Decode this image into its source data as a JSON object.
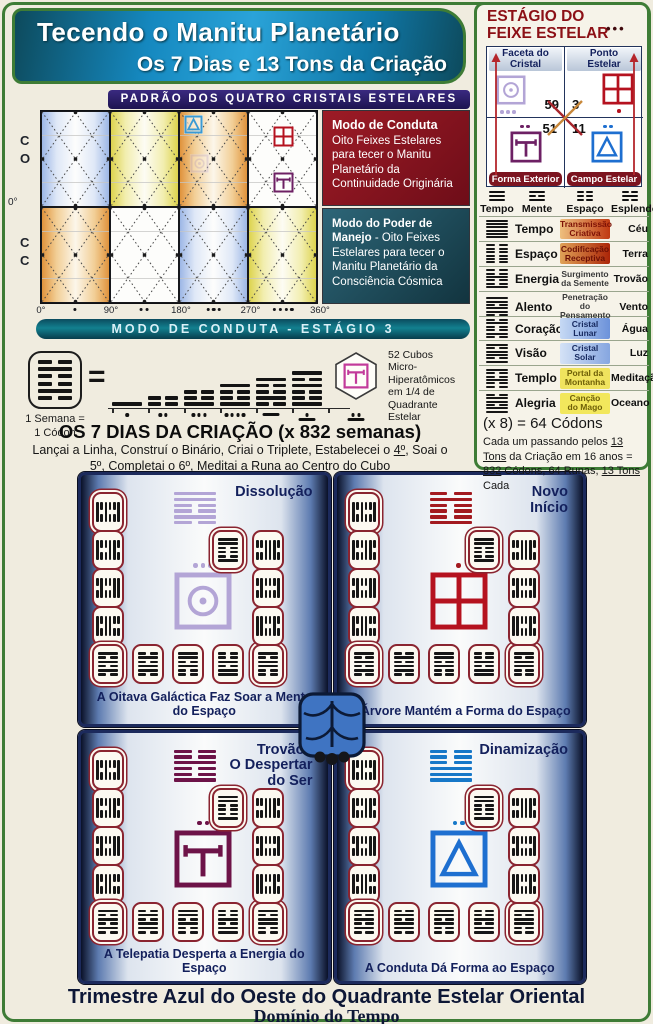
{
  "palette": {
    "frame_green": "#3e7c36",
    "header_blue": "#1a8fc4",
    "banner_purple": "#241a60",
    "box_red": "#8e1420",
    "box_teal": "#1f5a6b",
    "banner_teal": "#0e6f80",
    "navy": "#13205c",
    "card_border": "#8a2430",
    "seal_lavender": "#b3a5d6",
    "seal_red": "#b5121f",
    "seal_purple": "#6d2064",
    "seal_blue": "#1e6fd0",
    "mask_blue": "#3f74c2"
  },
  "header": {
    "title": "Tecendo o Manitu Planetário",
    "subtitle": "Os 7 Dias e 13 Tons da Criação"
  },
  "padrao_banner": "PADRÃO DOS QUATRO CRISTAIS ESTELARES",
  "chart": {
    "y_top_letters": [
      "C",
      "O"
    ],
    "y_mid": "0°",
    "y_bottom_letters": [
      "C",
      "C"
    ],
    "x_ticks": [
      "0°",
      "90°",
      "180°",
      "270°",
      "360°"
    ],
    "x_dot_groups": [
      1,
      2,
      3,
      4
    ],
    "panel_colors_top": [
      "blue",
      "yellow",
      "orange",
      "white"
    ],
    "panel_colors_bottom": [
      "orange",
      "white",
      "blue",
      "yellow"
    ],
    "overlay_glyphs": [
      {
        "row": 0,
        "col": 2,
        "seal": "star-field",
        "color": "#3a9ad4",
        "pos": "tl",
        "faded": false,
        "size": 19
      },
      {
        "row": 0,
        "col": 2,
        "seal": "crystal-facet",
        "color": "#c4b4d6",
        "pos": "ml",
        "faded": true,
        "size": 19
      },
      {
        "row": 0,
        "col": 3,
        "seal": "star-point",
        "color": "#b5121f",
        "pos": "um",
        "faded": false,
        "size": 21
      },
      {
        "row": 0,
        "col": 3,
        "seal": "exterior-form",
        "color": "#6d2064",
        "pos": "lm",
        "faded": false,
        "size": 21
      }
    ]
  },
  "mode_boxes": {
    "conduta_title": "Modo de Conduta",
    "conduta_body": "Oito Feixes Estelares para tecer o Manitu Planetário da Continuidade Originária",
    "manejo_title": "Modo do Poder de Manejo",
    "manejo_body": " - Oito Feixes Estelares para tecer o Manitu Planetário da Consciência Cósmica"
  },
  "conduta_banner": "MODO DE CONDUTA - ESTÁGIO 3",
  "seven_days": {
    "codon_icon_lines": [
      0,
      1,
      0,
      0,
      1,
      0
    ],
    "week_label": "1 Semana =\n1 Códon",
    "equals": "=",
    "day_stacks": [
      [
        1
      ],
      [
        0,
        0
      ],
      [
        0,
        0,
        1
      ],
      [
        1,
        0,
        0,
        1
      ],
      [
        1,
        0,
        0,
        1,
        0
      ],
      [
        1,
        0,
        1,
        0,
        0,
        1
      ]
    ],
    "mayan_values": [
      1,
      2,
      3,
      4,
      5,
      6,
      7
    ],
    "hexagon_seal": "exterior-form",
    "hexagon_seal_color": "#c23a9a",
    "cubes_note": "52 Cubos\nMicro-Hiperatômicos\nem 1/4 de Quadrante\nEstelar",
    "title": "OS 7 DIAS DA CRIAÇÃO (x 832 semanas)",
    "subtitle_segments": [
      {
        "t": "Lançai a Linha, Construí o Binário, Criai o Triplete, Estabelecei o "
      },
      {
        "t": "4º",
        "u": true
      },
      {
        "t": ", Soai o "
      },
      {
        "t": "5º",
        "u": true
      },
      {
        "t": ", Completai o "
      },
      {
        "t": "6º",
        "u": true
      },
      {
        "t": ", Meditai a Runa ao Centro do Cubo"
      }
    ]
  },
  "estagio": {
    "title_line1": "ESTÁGIO DO",
    "title_line2": "FEIXE ESTELAR",
    "dots": "•••",
    "cells": {
      "tl": {
        "label": "Faceta do\nCristal",
        "number": "59",
        "seal": "crystal-facet",
        "seal_color": "#b3a5d6",
        "dots_below": 3
      },
      "tr": {
        "label": "Ponto\nEstelar",
        "number": "3",
        "seal": "star-point",
        "seal_color": "#b5121f",
        "dots_below": 1
      },
      "bl": {
        "ribbon": "Forma Exterior",
        "number": "51",
        "seal": "exterior-form",
        "seal_color": "#6d2064",
        "dots_above": 2
      },
      "br": {
        "ribbon": "Campo Estelar",
        "number": "11",
        "seal": "star-field",
        "seal_color": "#1e6fd0",
        "dots_above": 2
      }
    }
  },
  "matrix": {
    "trigrams": [
      [
        1,
        1,
        1
      ],
      [
        1,
        0,
        1
      ],
      [
        0,
        0,
        0
      ],
      [
        0,
        1,
        0
      ]
    ],
    "headers": [
      "Tempo",
      "Mente",
      "Espaço",
      "Esplendor"
    ],
    "rows": [
      {
        "hex": [
          1,
          1,
          1,
          1,
          1,
          1
        ],
        "name": "Tempo",
        "phrase": "Transmissão\nCriativa",
        "result": "Céu",
        "bg": "linear-gradient(90deg,#eebf7e,#c03a12)",
        "fg": "#7e1206"
      },
      {
        "hex": [
          0,
          0,
          0,
          0,
          0,
          0
        ],
        "name": "Espaço",
        "phrase": "Codificação\nReceptiva",
        "result": "Terra",
        "bg": "linear-gradient(90deg,#e0a257,#ab2508)",
        "fg": "#6d1005"
      },
      {
        "hex": [
          0,
          0,
          1,
          0,
          0,
          1
        ],
        "name": "Energia",
        "phrase": "Surgimento\nda Semente",
        "result": "Trovão",
        "bg": "transparent",
        "fg": "#3a3a3a"
      },
      {
        "hex": [
          1,
          1,
          0,
          1,
          1,
          0
        ],
        "name": "Alento",
        "phrase": "Penetração do\nPensamento",
        "result": "Vento",
        "bg": "transparent",
        "fg": "#3a3a3a"
      },
      {
        "hex": [
          0,
          1,
          0,
          0,
          1,
          0
        ],
        "name": "Coração",
        "phrase": "Cristal\nLunar",
        "result": "Água",
        "bg": "linear-gradient(90deg,#c6d9f4,#6c92da)",
        "fg": "#16295f"
      },
      {
        "hex": [
          1,
          0,
          1,
          1,
          0,
          1
        ],
        "name": "Visão",
        "phrase": "Cristal\nSolar",
        "result": "Luz",
        "bg": "linear-gradient(90deg,#d4e2f6,#86a6e0)",
        "fg": "#16295f"
      },
      {
        "hex": [
          1,
          0,
          0,
          1,
          0,
          0
        ],
        "name": "Templo",
        "phrase": "Portal da\nMontanha",
        "result": "Meditação",
        "bg": "#f0e35e",
        "fg": "#6f6008"
      },
      {
        "hex": [
          0,
          1,
          1,
          0,
          1,
          1
        ],
        "name": "Alegria",
        "phrase": "Canção\ndo Mago",
        "result": "Oceano",
        "bg": "#f2e75c",
        "fg": "#6f6008"
      }
    ]
  },
  "codons": {
    "line1": "(x 8) = 64 Códons",
    "segments": [
      {
        "t": "Cada um passando pelos "
      },
      {
        "t": "13 Tons",
        "u": true
      },
      {
        "t": " da Criação em 16 anos = "
      },
      {
        "t": "832",
        "u": true
      },
      {
        "t": " Códons, 64 Runas, "
      },
      {
        "t": "13 Tons",
        "u": true
      },
      {
        "t": " Cada"
      }
    ]
  },
  "quadrants": [
    {
      "title": "Dissolução",
      "hexagram": [
        1,
        1,
        0,
        0,
        1,
        0
      ],
      "ink": "#b3a5d6",
      "seal": "crystal-facet",
      "seal_color": "#b3a5d6",
      "dots": 3,
      "caption": "A Oitava Galáctica Faz Soar a Mente do Espaço"
    },
    {
      "title": "Novo\nInício",
      "hexagram": [
        0,
        1,
        0,
        0,
        0,
        1
      ],
      "ink": "#a31a20",
      "seal": "star-point",
      "seal_color": "#b5121f",
      "dots": 1,
      "caption": "A Árvore Mantém a Forma do Espaço"
    },
    {
      "title": "Trovão /\nO Despertar\ndo Ser",
      "hexagram": [
        0,
        0,
        1,
        0,
        0,
        1
      ],
      "ink": "#6d1348",
      "seal": "exterior-form",
      "seal_color": "#6d1348",
      "dots": 2,
      "caption": "A Telepatia Desperta a Energia do Espaço"
    },
    {
      "title": "Dinamização",
      "hexagram": [
        0,
        0,
        0,
        1,
        1,
        1
      ],
      "ink": "#1778c8",
      "seal": "star-field",
      "seal_color": "#1e6fd0",
      "dots": 2,
      "caption": "A Conduta Dá Forma ao Espaço"
    }
  ],
  "card_patterns": [
    [
      1,
      0,
      0,
      1,
      0,
      1
    ],
    [
      0,
      1,
      1,
      0,
      0,
      1
    ],
    [
      1,
      1,
      0,
      0,
      1,
      0
    ],
    [
      0,
      0,
      1,
      1,
      0,
      1
    ],
    [
      1,
      0,
      1,
      0,
      1,
      0
    ],
    [
      0,
      1,
      0,
      1,
      1,
      0
    ],
    [
      1,
      1,
      0,
      1,
      0,
      0
    ],
    [
      0,
      0,
      1,
      0,
      1,
      1
    ],
    [
      1,
      0,
      1,
      1,
      0,
      0
    ],
    [
      0,
      1,
      0,
      0,
      1,
      1
    ],
    [
      1,
      0,
      0,
      0,
      1,
      0
    ],
    [
      0,
      1,
      1,
      1,
      0,
      0
    ],
    [
      1,
      1,
      0,
      0,
      0,
      1
    ]
  ],
  "bottom": {
    "title": "Trimestre Azul do Oeste do Quadrante Estelar Oriental",
    "subtitle": "Domínio do Tempo"
  }
}
